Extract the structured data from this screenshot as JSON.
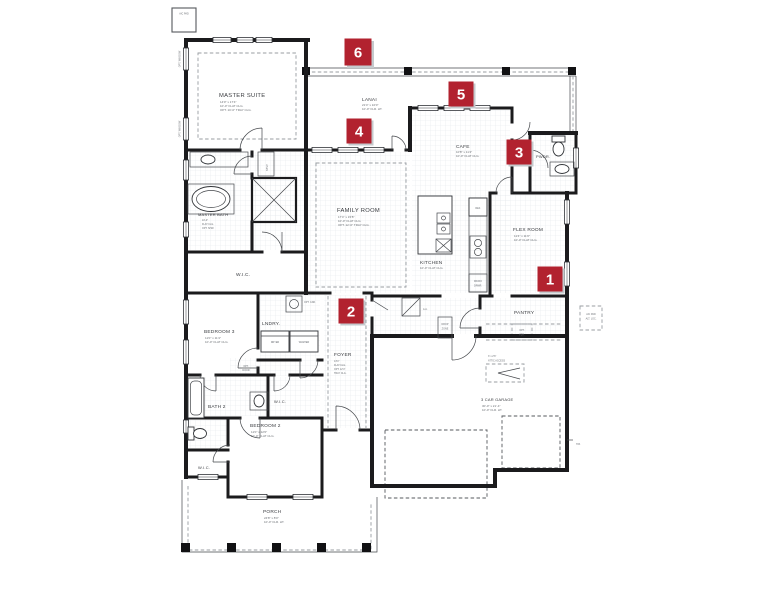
{
  "colors": {
    "marker_red": "#b2222f",
    "wall": "#1b1b1d",
    "shadow": "#c5cacd"
  },
  "site": {
    "ac_pad": "A/C PAD",
    "ac_pad_alt_1": "A/C PAD",
    "ac_pad_alt_2": "ALT. LOC.",
    "hose_bib": "H.B.",
    "opt_window": "OPT. WINDOW"
  },
  "markers": [
    {
      "n": "1"
    },
    {
      "n": "2"
    },
    {
      "n": "3"
    },
    {
      "n": "4"
    },
    {
      "n": "5"
    },
    {
      "n": "6"
    }
  ],
  "rooms": {
    "master_suite": {
      "name": "MASTER SUITE",
      "line1": "14'0\" x 17'4\"",
      "line2": "10'-0\" FLAT CLG.",
      "line3": "OPT. 10'-0\" TRAY CLG."
    },
    "lanai": {
      "name": "LANAI",
      "line1": "21'4\" x 10'0\"",
      "line2": "10'-0\" FLR. HT."
    },
    "cafe": {
      "name": "CAFE",
      "line1": "10'8\" x 11'4\"",
      "line2": "10'-0\" FLAT CLG."
    },
    "family_room": {
      "name": "FAMILY ROOM",
      "line1": "17'4\" x 15'8\"",
      "line2": "10'-0\" FLAT CLG.",
      "line3": "OPT. 12'-0\" TRAY CLG."
    },
    "kitchen": {
      "name": "KITCHEN",
      "line1": "10'-0\" FLAT CLG."
    },
    "flex_room": {
      "name": "FLEX ROOM",
      "line1": "11'4\" x 11'0\"",
      "line2": "10'-0\" FLAT CLG."
    },
    "powder": {
      "name": "PWDR."
    },
    "pantry": {
      "name": "PANTRY",
      "opt1": "OPT.",
      "opt2": "FZR."
    },
    "master_bath": {
      "name": "MASTER BATH",
      "line1": "10'-0\"",
      "line2": "FLAT CLG.",
      "line3": "OPT. SHW."
    },
    "wic_master": {
      "name": "W.I.C."
    },
    "linen": {
      "name": "LINEN"
    },
    "laundry": {
      "name": "LNDRY.",
      "dryer": "DRYER",
      "washer": "WASHER",
      "opt_cab": "OPT. CAB."
    },
    "foyer": {
      "name": "FOYER",
      "line1": "13'4\"",
      "line2": "FLAT CLG.",
      "line3": "OPT. 12'4\"",
      "line4": "TRAY CLG."
    },
    "bedroom3": {
      "name": "BEDROOM 3",
      "line1": "11'0\" x 11'4\"",
      "line2": "10'-0\" FLAT CLG."
    },
    "opt_door": {
      "line1": "OPT.",
      "line2": "DOOR"
    },
    "bath2": {
      "name": "BATH 2"
    },
    "wic_hall": {
      "name": "W.I.C."
    },
    "bedroom2": {
      "name": "BEDROOM 2",
      "line1": "11'0\" x 12'0\"",
      "line2": "10'-0\" FLAT CLG."
    },
    "wic_bed2": {
      "name": "W.I.C."
    },
    "porch": {
      "name": "PORCH",
      "line1": "24'8\" x 8'0\"",
      "line2": "10'-0\" FLR. HT."
    },
    "garage": {
      "name": "3 CAR GARAGE",
      "line1": "30'-0\" x 21'-4\"",
      "line2": "10'-0\" FLR. HT.",
      "attic1": "3' x 2'6\"",
      "attic2": "ATTIC ACCESS",
      "aa": "A.A.",
      "drop1": "DROP",
      "drop2": "ZONE"
    },
    "kitchen_fixtures": {
      "ref": "REF.",
      "micro1": "MICRO",
      "micro2": "DRWR."
    }
  }
}
